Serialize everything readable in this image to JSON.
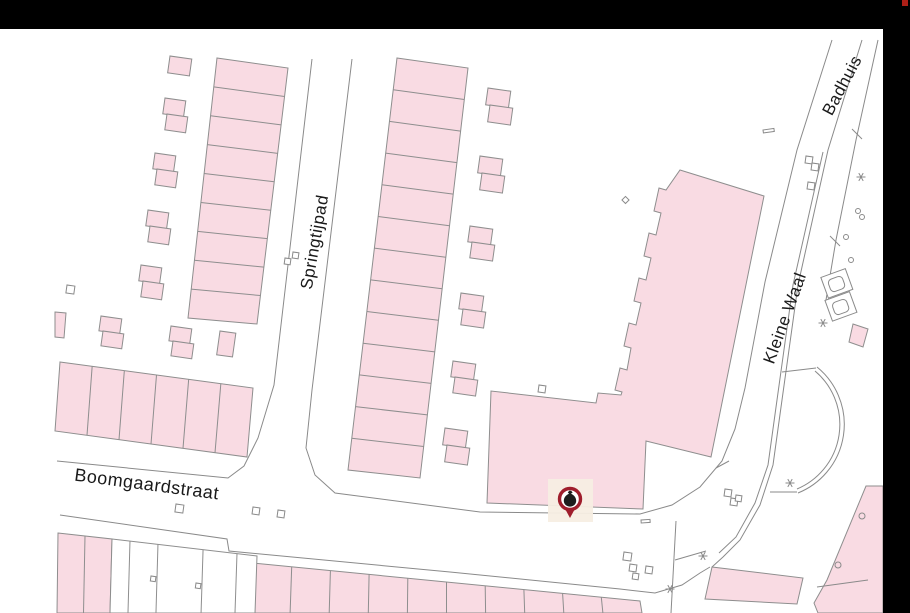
{
  "window": {
    "top_bar": {
      "x": 0,
      "y": 0,
      "w": 910,
      "h": 29,
      "color": "#000000"
    },
    "right_bar": {
      "x": 883,
      "y": 0,
      "w": 27,
      "h": 613,
      "color": "#000000"
    },
    "red_square": {
      "x": 902,
      "y": 0,
      "w": 6,
      "h": 6,
      "color": "#AD1F17"
    }
  },
  "map": {
    "background": "#ffffff",
    "building_fill": "#F9DBE3",
    "building_stroke": "#8E8E8E",
    "line_color": "#8A8A8A",
    "label_color": "#1A1A1A",
    "street_labels": [
      {
        "id": "springtijpad",
        "text": "Springtijpad",
        "x": 320,
        "y": 243,
        "rotation": -80,
        "size": 17
      },
      {
        "id": "boomgaardstraat",
        "text": "Boomgaardstraat",
        "x": 146,
        "y": 490,
        "rotation": 7.5,
        "size": 18
      },
      {
        "id": "kleine-waal",
        "text": "Kleine Waal",
        "x": 790,
        "y": 320,
        "rotation": -70,
        "size": 17
      },
      {
        "id": "badhuis",
        "text": "Badhuis",
        "x": 847,
        "y": 88,
        "rotation": -62,
        "size": 17
      }
    ],
    "marker": {
      "type": "waste-collection-point",
      "x": 570,
      "y": 499,
      "ring_color": "#9F1D2C",
      "icon_color": "#1D1D1D",
      "halo_color": "#F7EEE3",
      "fill": "#FFFFFF"
    }
  },
  "geometry": {
    "strips": [
      {
        "name": "terrace-row-nw",
        "outline": [
          [
            217,
            58
          ],
          [
            288,
            68
          ],
          [
            257,
            324
          ],
          [
            188,
            318
          ]
        ],
        "cells": 9,
        "divide": "h"
      },
      {
        "name": "terrace-row-east-of-springtijpad",
        "outline": [
          [
            397,
            58
          ],
          [
            468,
            68
          ],
          [
            420,
            478
          ],
          [
            348,
            470
          ]
        ],
        "cells": 13,
        "divide": "h"
      },
      {
        "name": "row-houses-west-boomgaardstraat",
        "outline": [
          [
            60,
            362
          ],
          [
            253,
            388
          ],
          [
            247,
            457
          ],
          [
            55,
            431
          ]
        ],
        "cells": 6,
        "divide": "v"
      },
      {
        "name": "row-houses-south-boomgaardstraat",
        "outline": [
          [
            253,
            563
          ],
          [
            640,
            601
          ],
          [
            642,
            613
          ],
          [
            251,
            613
          ]
        ],
        "cells": 10,
        "divide": "v"
      },
      {
        "name": "parcels-southwest-pink",
        "outline": [
          [
            58,
            533
          ],
          [
            112,
            539
          ],
          [
            110,
            613
          ],
          [
            57,
            613
          ]
        ],
        "cells": 2,
        "divide": "v"
      },
      {
        "name": "parcels-southwest-white",
        "outline": [
          [
            112,
            539
          ],
          [
            257,
            556
          ],
          [
            255,
            613
          ],
          [
            110,
            613
          ]
        ],
        "cells": 5,
        "divide": "v",
        "fractions": [
          0.124,
          0.317,
          0.628,
          0.862
        ],
        "fill": "#ffffff"
      }
    ],
    "polygons": [
      {
        "name": "building-complex-kleine-waal",
        "points": [
          [
            680,
            170
          ],
          [
            764,
            196
          ],
          [
            711,
            457
          ],
          [
            646,
            441
          ],
          [
            643,
            509
          ],
          [
            487,
            503
          ],
          [
            491,
            391
          ],
          [
            596,
            403
          ],
          [
            598,
            393
          ],
          [
            621,
            395
          ],
          [
            622,
            392
          ],
          [
            615,
            390
          ],
          [
            620,
            368
          ],
          [
            627,
            370
          ],
          [
            631,
            348
          ],
          [
            624,
            346
          ],
          [
            629,
            323
          ],
          [
            636,
            325
          ],
          [
            641,
            303
          ],
          [
            634,
            301
          ],
          [
            639,
            278
          ],
          [
            646,
            280
          ],
          [
            651,
            258
          ],
          [
            644,
            256
          ],
          [
            649,
            233
          ],
          [
            656,
            235
          ],
          [
            661,
            213
          ],
          [
            654,
            211
          ],
          [
            659,
            188
          ],
          [
            666,
            190
          ]
        ]
      },
      {
        "name": "parcel-sliver-west",
        "points": [
          [
            55,
            312
          ],
          [
            66,
            313
          ],
          [
            64,
            338
          ],
          [
            55,
            337
          ]
        ]
      },
      {
        "name": "parcel-sliver-east",
        "points": [
          [
            853,
            324
          ],
          [
            868,
            329
          ],
          [
            863,
            347
          ],
          [
            849,
            342
          ]
        ]
      },
      {
        "name": "parcel-south-center",
        "points": [
          [
            712,
            567
          ],
          [
            803,
            578
          ],
          [
            797,
            604
          ],
          [
            705,
            599
          ]
        ]
      },
      {
        "name": "parcel-southeast",
        "points": [
          [
            866,
            486
          ],
          [
            883,
            486
          ],
          [
            883,
            613
          ],
          [
            818,
            613
          ],
          [
            814,
            603
          ],
          [
            827,
            580
          ]
        ]
      }
    ],
    "polylines": [
      {
        "name": "springtijpad-west-edge",
        "points": [
          [
            312,
            59
          ],
          [
            274,
            385
          ],
          [
            258,
            438
          ],
          [
            244,
            466
          ],
          [
            228,
            478
          ],
          [
            57,
            461
          ]
        ]
      },
      {
        "name": "main-street-edge-north",
        "points": [
          [
            352,
            59
          ],
          [
            312,
            390
          ],
          [
            306,
            448
          ],
          [
            315,
            475
          ],
          [
            335,
            493
          ],
          [
            480,
            512
          ],
          [
            640,
            514
          ],
          [
            672,
            505
          ],
          [
            700,
            487
          ],
          [
            722,
            461
          ],
          [
            735,
            429
          ],
          [
            745,
            388
          ],
          [
            765,
            282
          ],
          [
            797,
            150
          ],
          [
            832,
            40
          ]
        ]
      },
      {
        "name": "boomgaardstraat-south-edge",
        "points": [
          [
            60,
            515
          ],
          [
            227,
            539
          ],
          [
            229,
            551
          ],
          [
            450,
            572
          ],
          [
            620,
            589
          ],
          [
            655,
            593
          ],
          [
            682,
            585
          ],
          [
            700,
            573
          ],
          [
            710,
            567
          ]
        ]
      },
      {
        "name": "kleine-waal-east-edge",
        "points": [
          [
            862,
            40
          ],
          [
            828,
            150
          ],
          [
            798,
            285
          ],
          [
            782,
            400
          ],
          [
            773,
            465
          ],
          [
            760,
            505
          ],
          [
            740,
            540
          ],
          [
            723,
            557
          ],
          [
            712,
            567
          ]
        ]
      },
      {
        "name": "kleine-waal-east-inner-edge",
        "points": [
          [
            823,
            152
          ],
          [
            793,
            285
          ],
          [
            777,
            400
          ],
          [
            768,
            465
          ],
          [
            755,
            503
          ],
          [
            736,
            537
          ],
          [
            719,
            553
          ]
        ]
      },
      {
        "name": "badhuis-east-edge",
        "points": [
          [
            878,
            40
          ],
          [
            856,
            140
          ],
          [
            836,
            240
          ],
          [
            826,
            300
          ]
        ]
      },
      {
        "name": "south-street-west-edge",
        "points": [
          [
            676,
            521
          ],
          [
            671,
            613
          ]
        ]
      },
      {
        "name": "corner-chamfer",
        "points": [
          [
            675,
            560
          ],
          [
            706,
            551
          ]
        ]
      },
      {
        "name": "parcel-inner-line",
        "points": [
          [
            817,
            587
          ],
          [
            868,
            580
          ]
        ]
      },
      {
        "name": "arc-top-tie",
        "points": [
          [
            782,
            372
          ],
          [
            816,
            368
          ]
        ]
      },
      {
        "name": "arc-bottom-tie",
        "points": [
          [
            770,
            492
          ],
          [
            797,
            492
          ]
        ]
      },
      {
        "name": "tick-west-edge",
        "points": [
          [
            716,
            468
          ],
          [
            729,
            461
          ]
        ]
      },
      {
        "name": "tick-badhuis-1",
        "points": [
          [
            852,
            129
          ],
          [
            862,
            139
          ]
        ]
      },
      {
        "name": "tick-badhuis-2",
        "points": [
          [
            830,
            236
          ],
          [
            840,
            246
          ]
        ]
      }
    ],
    "arcs": [
      {
        "name": "turning-circle-outer",
        "d": "M817,367 A74,74 0 0 1 798,493"
      },
      {
        "name": "turning-circle-inner",
        "d": "M815,371 A70,70 0 0 1 797,489"
      }
    ],
    "sheds": [
      [
        170,
        56,
        22,
        17
      ],
      [
        165,
        98,
        21,
        16
      ],
      [
        167,
        114,
        21,
        16
      ],
      [
        155,
        153,
        21,
        16
      ],
      [
        157,
        169,
        21,
        16
      ],
      [
        148,
        210,
        21,
        16
      ],
      [
        150,
        226,
        21,
        16
      ],
      [
        141,
        265,
        21,
        16
      ],
      [
        143,
        281,
        21,
        16
      ],
      [
        101,
        316,
        21,
        15
      ],
      [
        103,
        331,
        21,
        15
      ],
      [
        171,
        326,
        21,
        15
      ],
      [
        173,
        341,
        21,
        15
      ],
      [
        220,
        331,
        16,
        24
      ],
      [
        488,
        88,
        23,
        17
      ],
      [
        490,
        105,
        23,
        17
      ],
      [
        480,
        156,
        23,
        17
      ],
      [
        482,
        173,
        23,
        17
      ],
      [
        470,
        226,
        23,
        16
      ],
      [
        472,
        242,
        23,
        16
      ],
      [
        461,
        293,
        23,
        16
      ],
      [
        463,
        309,
        23,
        16
      ],
      [
        453,
        361,
        23,
        16
      ],
      [
        455,
        377,
        23,
        16
      ],
      [
        445,
        428,
        23,
        17
      ],
      [
        447,
        445,
        23,
        17
      ]
    ],
    "small_squares": [
      [
        67,
        285,
        8
      ],
      [
        539,
        385,
        7
      ],
      [
        285,
        258,
        6
      ],
      [
        293,
        252,
        6
      ],
      [
        176,
        504,
        8
      ],
      [
        253,
        507,
        7
      ],
      [
        278,
        510,
        7
      ],
      [
        624,
        552,
        8
      ],
      [
        630,
        564,
        7
      ],
      [
        633,
        573,
        6
      ],
      [
        646,
        566,
        7
      ],
      [
        725,
        489,
        7
      ],
      [
        731,
        498,
        7
      ],
      [
        736,
        495,
        6
      ],
      [
        806,
        156,
        7
      ],
      [
        812,
        163,
        7
      ],
      [
        808,
        182,
        7
      ],
      [
        151,
        576,
        5
      ],
      [
        196,
        583,
        5
      ]
    ],
    "circles": [
      [
        846,
        237,
        2.5
      ],
      [
        851,
        260,
        2.5
      ],
      [
        840,
        283,
        2.5
      ],
      [
        858,
        211,
        2.5
      ],
      [
        862,
        217,
        2.5
      ],
      [
        862,
        516,
        3
      ],
      [
        838,
        565,
        3
      ]
    ],
    "diamonds": [
      [
        826,
        402,
        5
      ]
    ],
    "asterisks": [
      [
        861,
        177
      ],
      [
        823,
        323
      ],
      [
        790,
        483
      ],
      [
        670,
        589
      ],
      [
        703,
        556
      ]
    ],
    "containers": {
      "rotation": -20,
      "cx": 840,
      "cy": 295,
      "outer": [
        [
          828,
          272,
          26,
          22
        ],
        [
          824,
          295,
          26,
          22
        ]
      ],
      "inner": [
        [
          833,
          277,
          15,
          13
        ],
        [
          829,
          300,
          15,
          13
        ]
      ]
    },
    "dashes": [
      {
        "x": 763,
        "y": 130,
        "w": 11,
        "h": 3,
        "rot": -8
      },
      {
        "x": 641,
        "y": 520,
        "w": 9,
        "h": 3,
        "rot": -4
      }
    ]
  }
}
